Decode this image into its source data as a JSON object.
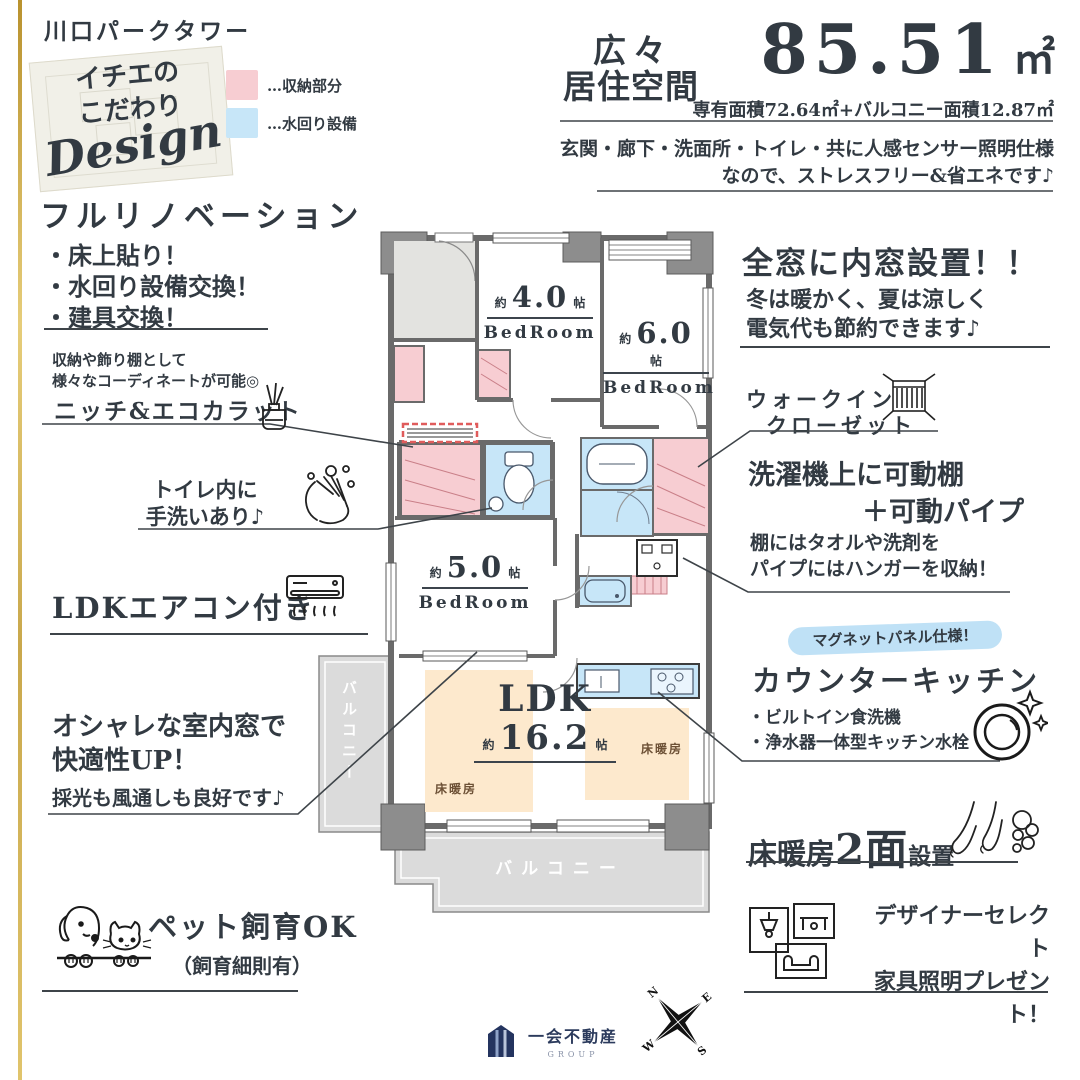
{
  "header": {
    "building": "川口パークタワー",
    "card": {
      "line1": "イチエの",
      "line2": "こだわり",
      "script": "Design"
    },
    "legend": [
      {
        "label": "…収納部分",
        "color": "#f7cdd2"
      },
      {
        "label": "…水回り設備",
        "color": "#c7e6f8"
      }
    ],
    "area": {
      "title1": "広々",
      "title2": "居住空間",
      "value": "85.51",
      "unit": "㎡",
      "detail": "専有面積72.64㎡+バルコニー面積12.87㎡",
      "note1": "玄関・廊下・洗面所・トイレ・共に人感センサー照明仕様",
      "note2": "なので、ストレスフリー&省エネです♪"
    }
  },
  "left": {
    "reno": {
      "title": "フルリノベーション",
      "items": [
        "・床上貼り！",
        "・水回り設備交換！",
        "・建具交換！"
      ]
    },
    "niche": {
      "desc1": "収納や飾り棚として",
      "desc2": "様々なコーディネートが可能◎",
      "title": "ニッチ&エコカラット"
    },
    "toilet": {
      "line1": "トイレ内に",
      "line2": "手洗いあり♪"
    },
    "aircon": {
      "title": "LDKエアコン付き"
    },
    "window": {
      "line1": "オシャレな室内窓で",
      "line2": "快適性UP！",
      "line3": "採光も風通しも良好です♪"
    },
    "pet": {
      "title": "ペット飼育OK",
      "sub": "（飼育細則有）"
    }
  },
  "right": {
    "innerWindow": {
      "title": "全窓に内窓設置！！",
      "line1": "冬は暖かく、夏は涼しく",
      "line2": "電気代も節約できます♪"
    },
    "wic": {
      "line1": "ウォークイン",
      "line2": "クローゼット"
    },
    "laundry": {
      "title1": "洗濯機上に可動棚",
      "title2": "＋可動パイプ",
      "desc1": "棚にはタオルや洗剤を",
      "desc2": "パイプにはハンガーを収納！"
    },
    "kitchen": {
      "badge": "マグネットパネル仕様！",
      "title": "カウンターキッチン",
      "items": [
        "・ビルトイン食洗機",
        "・浄水器一体型キッチン水栓"
      ]
    },
    "heating": {
      "pre": "床暖房",
      "big": "2面",
      "post": "設置"
    },
    "furniture": {
      "line1": "デザイナーセレクト",
      "line2": "家具照明プレゼント！"
    }
  },
  "plan": {
    "rooms": [
      {
        "approx": "約",
        "size": "4.0",
        "unit": "帖",
        "name": "BedRoom"
      },
      {
        "approx": "約",
        "size": "6.0",
        "unit": "帖",
        "name": "BedRoom"
      },
      {
        "approx": "約",
        "size": "5.0",
        "unit": "帖",
        "name": "BedRoom"
      }
    ],
    "ldk": {
      "name": "LDK",
      "approx": "約",
      "size": "16.2",
      "unit": "帖"
    },
    "floorHeatingLabel": "床暖房",
    "balconyLeft": "バルコニー",
    "balconyBottom": "バルコニー"
  },
  "compass": {
    "n": "N",
    "e": "E",
    "s": "S",
    "w": "W"
  },
  "logo": {
    "name": "一会不動産",
    "group": "GROUP"
  },
  "colors": {
    "storage": "#f7cdd2",
    "water": "#c7e6f8",
    "badge": "#bfe1f6",
    "gold": "#c9a84c",
    "text": "#323a42"
  }
}
